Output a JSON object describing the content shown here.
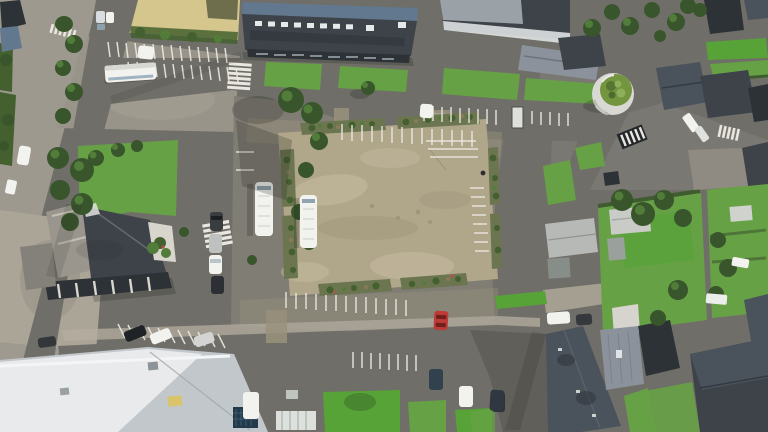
{
  "scene": {
    "title": "Aerial drone view of a small-town square with gravel plaza, parking bays, buses and slate-roofed houses",
    "time_of_day": "daytime, sunny with long soft shadows",
    "palette": {
      "asphalt": "#6f6e68",
      "asphaltDark": "#605f59",
      "apron": "#807d74",
      "lane": "#9a927d",
      "concrete": "#b4aea0",
      "parvis": "#aba598",
      "sand": "#d4c68c",
      "plaza": "#b0a68a",
      "plazaHi": "#c6bba0",
      "plazaLo": "#a0957a",
      "bed": "#6b7550",
      "bush": "#44602f",
      "grass": "#67a146",
      "grassHi": "#57a337",
      "tree": "#39552c",
      "treeHi": "#527c3a",
      "roofDark": "#3d4349",
      "roofDarker": "#2d3237",
      "roofBlue": "#62788e",
      "roofSlate": "#4a525c",
      "roofMetal": "#8b929b",
      "roofLight": "#c2c7cb",
      "roofWhite": "#e8eaeb",
      "vehicleWhite": "#f2f2ef",
      "carRed": "#bd3a36",
      "stripe": "#e9e7df"
    },
    "landmarks": [
      {
        "id": "central-square",
        "label": "central gravel plaza bordered by planted beds"
      },
      {
        "id": "school-building",
        "label": "long dark-roofed school/gym building with rooftop skylights"
      },
      {
        "id": "water-tower",
        "label": "round water tower with green planted roof"
      },
      {
        "id": "church-hall",
        "label": "stone hall with dark slate roof and glass gallery"
      },
      {
        "id": "metal-hall",
        "label": "large light metal-roofed hall, bottom left"
      },
      {
        "id": "sports-field",
        "label": "sand-coloured field, top left"
      },
      {
        "id": "houses",
        "label": "slate-roofed village houses with gardens, right side"
      },
      {
        "id": "tree-lined-street",
        "label": "tree-lined street, left edge"
      }
    ],
    "vehicles": {
      "coaches_parked": 3,
      "cars_visible": 16,
      "notable": [
        "two white coaches beside the plaza",
        "one white coach on the north lot",
        "red car near plaza south-east corner"
      ]
    },
    "markings": [
      "white parking bays on every lot",
      "four zebra crossings",
      "give-way shelter stripes near water tower"
    ]
  }
}
